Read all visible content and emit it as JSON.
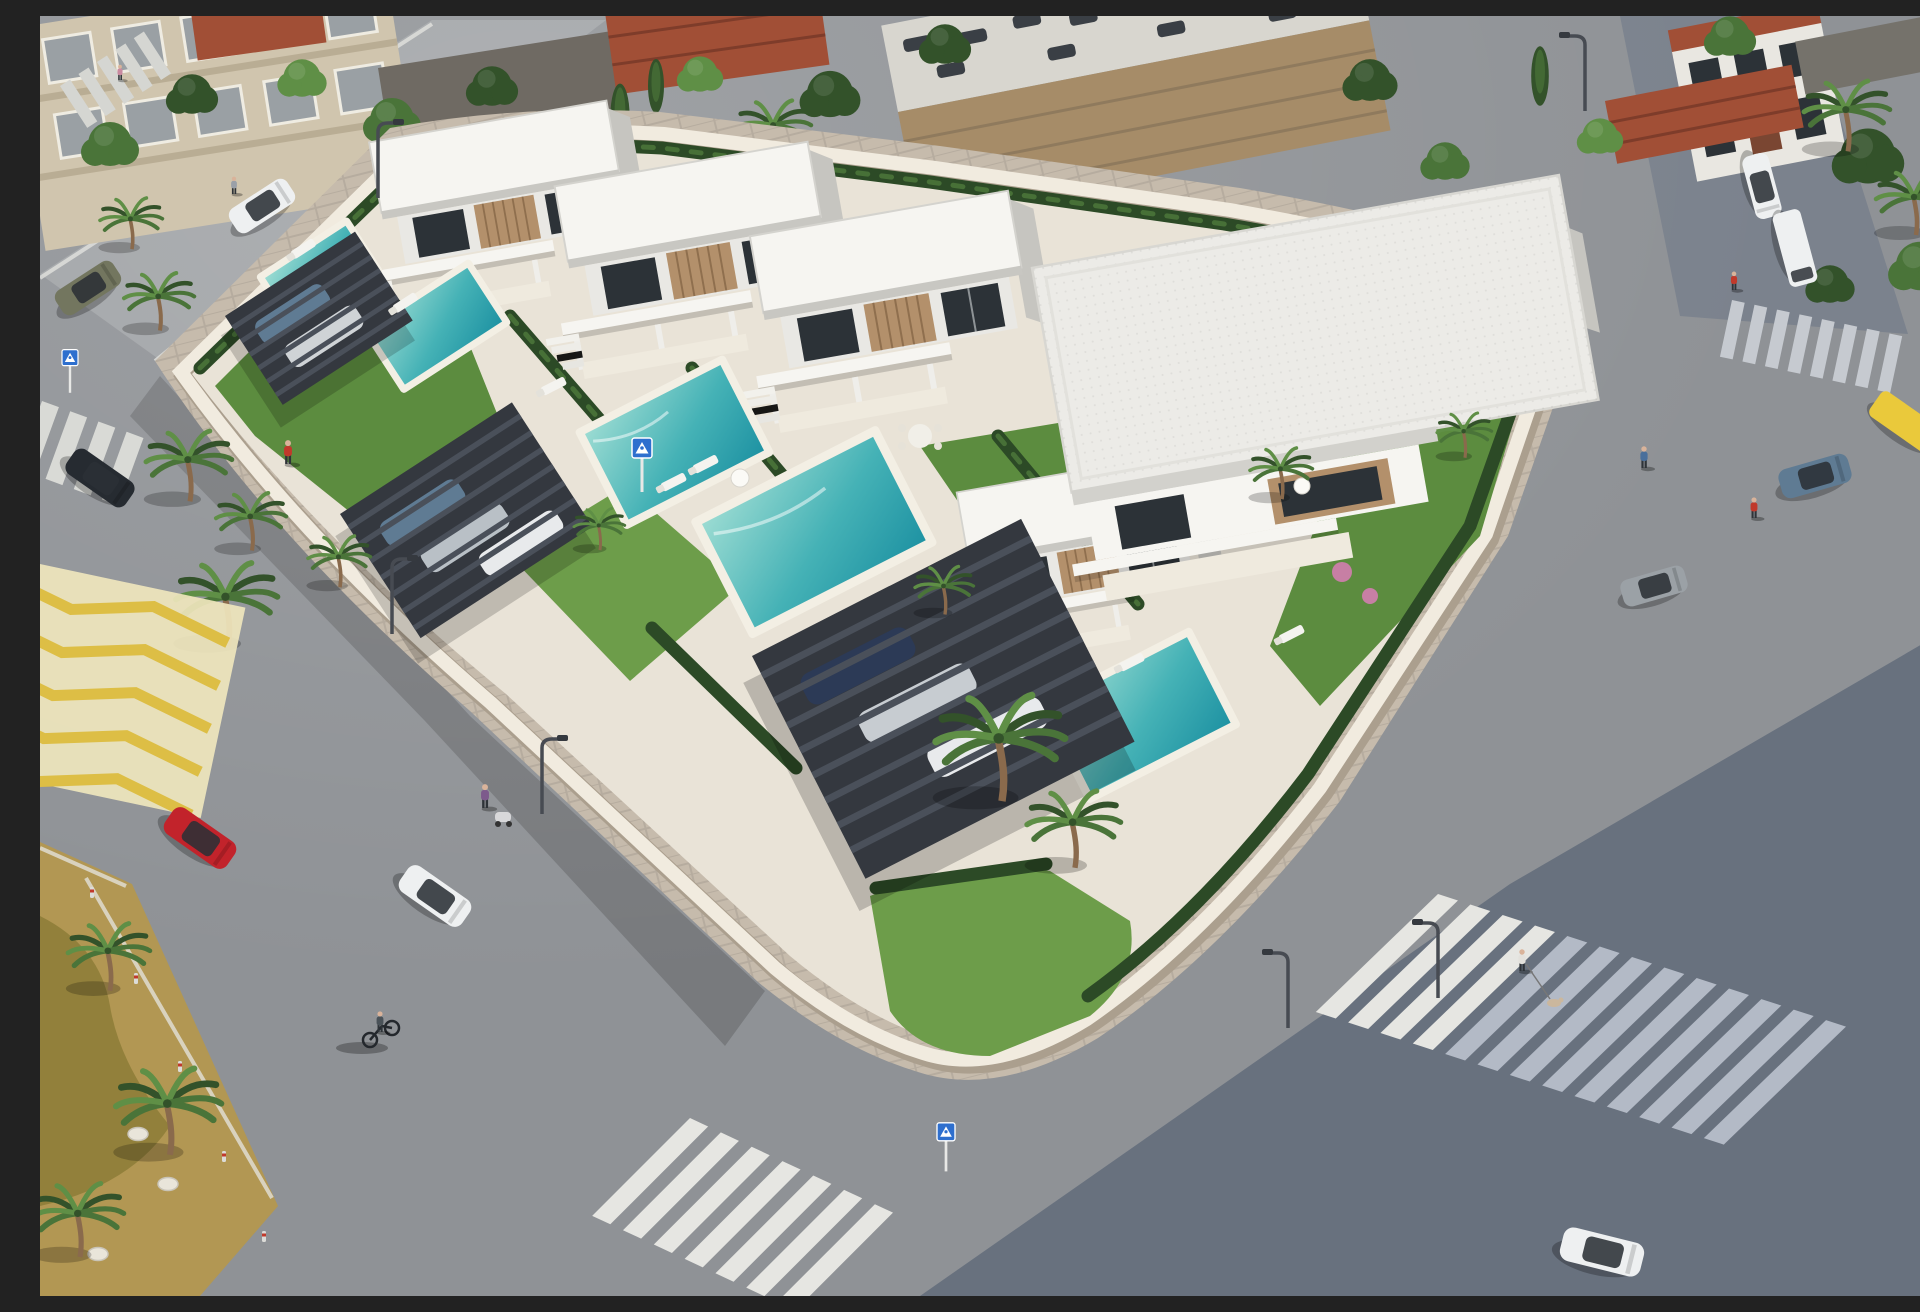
{
  "scene": {
    "type": "aerial-3d-architectural-render",
    "description": "Daytime aerial 3D rendering of a modern Mediterranean residential development: a walled block of white flat-roof two-storey villas with wood accents, private turquoise pools, lawns, hedges and dark steel pergola carports, surrounded by gray streets with zebra crosswalks, a yellow hatched no-parking zone, palm trees, parked and moving cars, and pedestrians; neighbouring beige apartment blocks, a tan warehouse with rooftop parking and red-tile townhouses sit along the top of the frame.",
    "time_of_day": "daytime, strong sun from upper right, long shadows to lower left"
  },
  "palette": {
    "asphalt": "#8f9296",
    "asphaltLight": "#a0a3a6",
    "asphaltShadow": "#68717e",
    "sidewalk": "#c6bbac",
    "paving": "#e9e3d7",
    "wallCream": "#f1ebdf",
    "wallShade": "#ab9f8e",
    "villaWhite": "#f6f5f1",
    "villaShade": "#dad9d4",
    "villaDark": "#c6c5c0",
    "wood": "#b3906b",
    "woodDark": "#8f6f4e",
    "glass": "#2c3237",
    "grass": "#5c8c3f",
    "grassLight": "#6d9d4a",
    "hedge": "#2c4a26",
    "poolLight": "#9adbd2",
    "poolMid": "#45b2b6",
    "poolDeep": "#1f93a3",
    "pergola": "#34383f",
    "pergolaSlat": "#4a505a",
    "stripeWhite": "#e6e6e2",
    "stripeShade": "#b3bac6",
    "yellowField": "#efe6bd",
    "yellowLine": "#ddbe45",
    "medianOchre": "#b29753",
    "medianGrass": "#897a36",
    "treeGreen": "#4a7439",
    "treeLight": "#5f8f46",
    "treeDark": "#33522a",
    "trunk": "#8a6a4c",
    "beige": "#d0c5ae",
    "beigeShade": "#b9ad94",
    "winGray": "#9aa0a4",
    "warehouseTan": "#a68c68",
    "warehouseRoof": "#d8d6cf",
    "tileRed": "#a14f36",
    "tileDark": "#7e3c2a",
    "carRed": "#c2232b",
    "carWhite": "#eef0f1",
    "carDark": "#262b31",
    "carOlive": "#73765f",
    "carBlue": "#5f7b93",
    "carGray": "#9ba1a6",
    "carYellow": "#eac93b",
    "shirtRed": "#c0392b",
    "shirtPurple": "#7d5a8c",
    "shirtBlue": "#4a6f9b",
    "shirtGray": "#9aa0a8",
    "signBlue": "#2e6fce",
    "stone": "#e9e5da",
    "flower": "#c77fa4"
  },
  "objects": {
    "development_block": {
      "villas": 7,
      "villa_style": "two-storey flat white roofs, cantilevered upper floor, wood-slat panels, dark glazing, white terrace slabs",
      "pools": 5,
      "pergola_carports": 3,
      "gardens": "lawns, dark hedges, small palms, pink flower bed",
      "perimeter": "cream rendered wall with rounded corner and tan paver sidewalk"
    },
    "road_markings": [
      "zebra crosswalks x5",
      "yellow hatched keep-clear zone",
      "white curb lines"
    ],
    "signs": [
      {
        "type": "pedestrian-crossing",
        "color": "blue",
        "count": 3
      }
    ],
    "street_lamps": 6,
    "bollards": 5,
    "vehicles": [
      {
        "type": "hatchback",
        "color": "red",
        "where": "left street"
      },
      {
        "type": "suv",
        "color": "white",
        "where": "left street"
      },
      {
        "type": "suv",
        "color": "dark",
        "where": "left street top"
      },
      {
        "type": "sedan",
        "color": "olive-gray",
        "where": "upper-left street"
      },
      {
        "type": "sedan",
        "color": "white",
        "state": "parked",
        "where": "upper-left curb"
      },
      {
        "type": "suv",
        "color": "white",
        "where": "top-right lane"
      },
      {
        "type": "van",
        "color": "white",
        "state": "parked",
        "where": "top-right lane"
      },
      {
        "type": "van",
        "color": "yellow",
        "where": "right street"
      },
      {
        "type": "sedan",
        "color": "steel-blue",
        "where": "right street"
      },
      {
        "type": "sedan",
        "color": "gray",
        "where": "right street"
      },
      {
        "type": "car",
        "color": "white",
        "where": "bottom street"
      }
    ],
    "pedestrians": [
      {
        "who": "person in red",
        "where": "left sidewalk"
      },
      {
        "who": "woman with stroller",
        "where": "left sidewalk"
      },
      {
        "who": "cyclist",
        "where": "bottom-left intersection"
      },
      {
        "who": "dog walker",
        "where": "bottom-right crosswalk"
      },
      {
        "who": "walker",
        "where": "right sidewalk"
      },
      {
        "who": "person in red",
        "where": "top-right lane"
      },
      {
        "who": "person crossing",
        "where": "right street"
      },
      {
        "who": "person standing",
        "where": "upper-left curb"
      },
      {
        "who": "small figure",
        "where": "top-left sidewalk"
      }
    ],
    "surroundings": [
      "beige apartment building",
      "dark-roof annex with red slats",
      "red-tile houses",
      "tan warehouse with rooftop parking",
      "white townhouses",
      "dense trees and palms",
      "ochre dry-grass median with white stones"
    ]
  }
}
